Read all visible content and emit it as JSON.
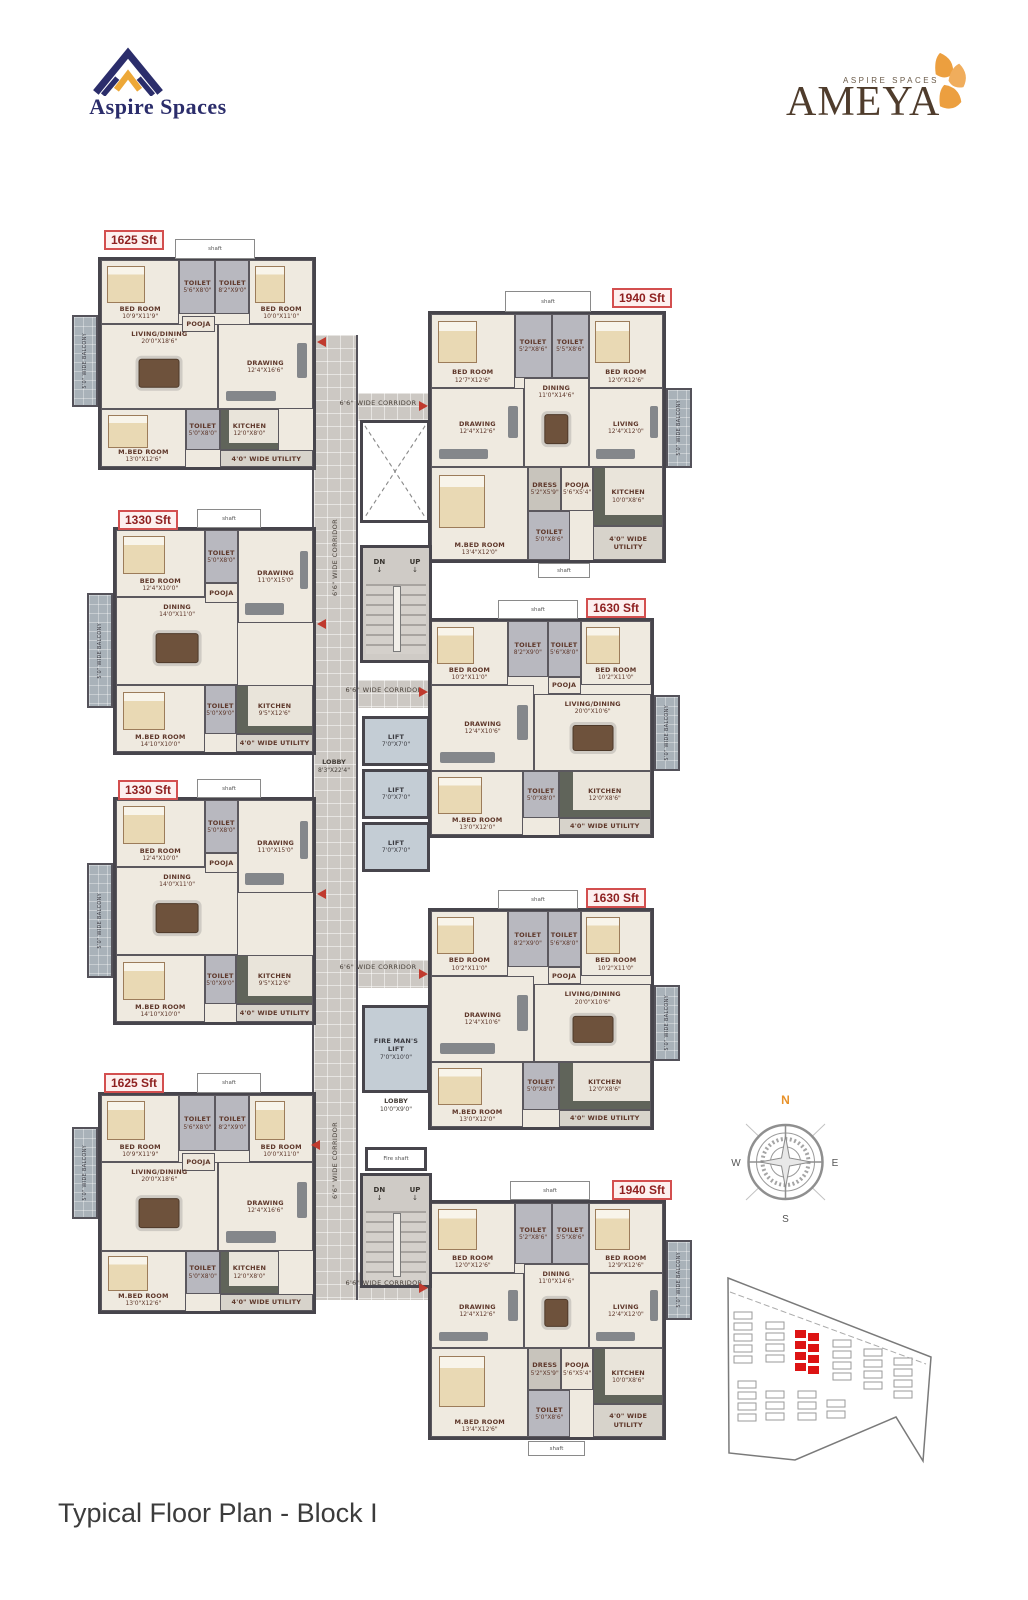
{
  "brand": {
    "left_name": "Aspire Spaces",
    "right_tag": "ASPIRE SPACES",
    "right_name": "AMEYA"
  },
  "title": "Typical Floor Plan - Block I",
  "compass": {
    "n": "N",
    "e": "E",
    "s": "S",
    "w": "W"
  },
  "core": {
    "corridor": "6'6\" WIDE CORRIDOR",
    "shaft": "shaft",
    "fire_shaft": "Fire shaft",
    "dn": "DN",
    "up": "UP",
    "lobby": "LOBBY",
    "lobby_dims": "8'3\"X22'4\"",
    "lift": "LIFT",
    "lift_dims": "7'0\"X7'0\"",
    "fire_lift": "FIRE MAN'S LIFT",
    "fire_lift_dims": "7'0\"X10'0\"",
    "lobby2": "LOBBY",
    "lobby2_dims": "10'0\"X9'0\""
  },
  "units": [
    {
      "id": "unit-1625-1",
      "sft": "1625 Sft",
      "type": "A",
      "balcony": "5'0\" WIDE BALCONY",
      "rooms": [
        {
          "label": "BED ROOM",
          "dims": "10'9\"X11'9\"",
          "kind": "bedroom"
        },
        {
          "label": "TOILET",
          "dims": "5'6\"X8'0\"",
          "kind": "toilet"
        },
        {
          "label": "TOILET",
          "dims": "8'2\"X9'0\"",
          "kind": "toilet"
        },
        {
          "label": "BED ROOM",
          "dims": "10'0\"X11'0\"",
          "kind": "bedroom"
        },
        {
          "label": "POOJA",
          "dims": "",
          "kind": "pooja"
        },
        {
          "label": "LIVING/DINING",
          "dims": "20'0\"X18'6\"",
          "kind": "dining"
        },
        {
          "label": "DRAWING",
          "dims": "12'4\"X16'6\"",
          "kind": "sofa"
        },
        {
          "label": "M.BED ROOM",
          "dims": "13'0\"X12'6\"",
          "kind": "bedroom"
        },
        {
          "label": "TOILET",
          "dims": "5'0\"X8'0\"",
          "kind": "toilet"
        },
        {
          "label": "KITCHEN",
          "dims": "12'0\"X8'0\"",
          "kind": "kitchen"
        },
        {
          "label": "4'0\" WIDE UTILITY",
          "dims": "",
          "kind": "utility"
        }
      ]
    },
    {
      "id": "unit-1940-1",
      "sft": "1940 Sft",
      "type": "B",
      "balcony": "5'0\" WIDE BALCONY",
      "rooms": [
        {
          "label": "BED ROOM",
          "dims": "12'7\"X12'6\"",
          "kind": "bedroom"
        },
        {
          "label": "TOILET",
          "dims": "5'2\"X8'6\"",
          "kind": "toilet"
        },
        {
          "label": "TOILET",
          "dims": "5'5\"X8'6\"",
          "kind": "toilet"
        },
        {
          "label": "BED ROOM",
          "dims": "12'0\"X12'6\"",
          "kind": "bedroom"
        },
        {
          "label": "DRAWING",
          "dims": "12'4\"X12'6\"",
          "kind": "sofa"
        },
        {
          "label": "DINING",
          "dims": "11'0\"X14'6\"",
          "kind": "dining"
        },
        {
          "label": "LIVING",
          "dims": "12'4\"X12'0\"",
          "kind": "sofa"
        },
        {
          "label": "M.BED ROOM",
          "dims": "13'4\"X12'0\"",
          "kind": "bedroom"
        },
        {
          "label": "DRESS",
          "dims": "5'2\"X5'9\"",
          "kind": "dress"
        },
        {
          "label": "POOJA",
          "dims": "5'6\"X5'4\"",
          "kind": "pooja"
        },
        {
          "label": "KITCHEN",
          "dims": "10'0\"X8'6\"",
          "kind": "kitchen"
        },
        {
          "label": "TOILET",
          "dims": "5'0\"X8'6\"",
          "kind": "toilet"
        },
        {
          "label": "4'0\" WIDE UTILITY",
          "dims": "",
          "kind": "utility"
        }
      ]
    },
    {
      "id": "unit-1330-1",
      "sft": "1330 Sft",
      "type": "C",
      "balcony": "5'0\" WIDE BALCONY",
      "rooms": [
        {
          "label": "BED ROOM",
          "dims": "12'4\"X10'0\"",
          "kind": "bedroom"
        },
        {
          "label": "TOILET",
          "dims": "5'0\"X8'0\"",
          "kind": "toilet"
        },
        {
          "label": "POOJA",
          "dims": "",
          "kind": "pooja"
        },
        {
          "label": "DRAWING",
          "dims": "11'0\"X15'0\"",
          "kind": "sofa"
        },
        {
          "label": "DINING",
          "dims": "14'0\"X11'0\"",
          "kind": "dining"
        },
        {
          "label": "M.BED ROOM",
          "dims": "14'10\"X10'0\"",
          "kind": "bedroom"
        },
        {
          "label": "TOILET",
          "dims": "5'0\"X9'0\"",
          "kind": "toilet"
        },
        {
          "label": "KITCHEN",
          "dims": "9'5\"X12'6\"",
          "kind": "kitchen"
        },
        {
          "label": "4'0\" WIDE UTILITY",
          "dims": "",
          "kind": "utility"
        }
      ]
    },
    {
      "id": "unit-1630-1",
      "sft": "1630 Sft",
      "type": "D",
      "balcony": "5'0\" WIDE BALCONY",
      "rooms": [
        {
          "label": "BED ROOM",
          "dims": "10'2\"X11'0\"",
          "kind": "bedroom"
        },
        {
          "label": "TOILET",
          "dims": "8'2\"X9'0\"",
          "kind": "toilet"
        },
        {
          "label": "TOILET",
          "dims": "5'6\"X8'0\"",
          "kind": "toilet"
        },
        {
          "label": "BED ROOM",
          "dims": "10'2\"X11'0\"",
          "kind": "bedroom"
        },
        {
          "label": "POOJA",
          "dims": "",
          "kind": "pooja"
        },
        {
          "label": "DRAWING",
          "dims": "12'4\"X10'6\"",
          "kind": "sofa"
        },
        {
          "label": "LIVING/DINING",
          "dims": "20'0\"X10'6\"",
          "kind": "dining"
        },
        {
          "label": "M.BED ROOM",
          "dims": "13'0\"X12'0\"",
          "kind": "bedroom"
        },
        {
          "label": "TOILET",
          "dims": "5'0\"X8'0\"",
          "kind": "toilet"
        },
        {
          "label": "KITCHEN",
          "dims": "12'0\"X8'6\"",
          "kind": "kitchen"
        },
        {
          "label": "4'0\" WIDE UTILITY",
          "dims": "",
          "kind": "utility"
        }
      ]
    },
    {
      "id": "unit-1330-2",
      "sft": "1330 Sft",
      "type": "C",
      "balcony": "5'0\" WIDE BALCONY",
      "rooms": [
        {
          "label": "BED ROOM",
          "dims": "12'4\"X10'0\"",
          "kind": "bedroom"
        },
        {
          "label": "TOILET",
          "dims": "5'0\"X8'0\"",
          "kind": "toilet"
        },
        {
          "label": "POOJA",
          "dims": "",
          "kind": "pooja"
        },
        {
          "label": "DRAWING",
          "dims": "11'0\"X15'0\"",
          "kind": "sofa"
        },
        {
          "label": "DINING",
          "dims": "14'0\"X11'0\"",
          "kind": "dining"
        },
        {
          "label": "M.BED ROOM",
          "dims": "14'10\"X10'0\"",
          "kind": "bedroom"
        },
        {
          "label": "TOILET",
          "dims": "5'0\"X9'0\"",
          "kind": "toilet"
        },
        {
          "label": "KITCHEN",
          "dims": "9'5\"X12'6\"",
          "kind": "kitchen"
        },
        {
          "label": "4'0\" WIDE UTILITY",
          "dims": "",
          "kind": "utility"
        }
      ]
    },
    {
      "id": "unit-1630-2",
      "sft": "1630 Sft",
      "type": "D",
      "balcony": "5'0\" WIDE BALCONY",
      "rooms": [
        {
          "label": "BED ROOM",
          "dims": "10'2\"X11'0\"",
          "kind": "bedroom"
        },
        {
          "label": "TOILET",
          "dims": "8'2\"X9'0\"",
          "kind": "toilet"
        },
        {
          "label": "TOILET",
          "dims": "5'6\"X8'0\"",
          "kind": "toilet"
        },
        {
          "label": "BED ROOM",
          "dims": "10'2\"X11'0\"",
          "kind": "bedroom"
        },
        {
          "label": "POOJA",
          "dims": "",
          "kind": "pooja"
        },
        {
          "label": "DRAWING",
          "dims": "12'4\"X10'6\"",
          "kind": "sofa"
        },
        {
          "label": "LIVING/DINING",
          "dims": "20'0\"X10'6\"",
          "kind": "dining"
        },
        {
          "label": "M.BED ROOM",
          "dims": "13'0\"X12'0\"",
          "kind": "bedroom"
        },
        {
          "label": "TOILET",
          "dims": "5'0\"X8'0\"",
          "kind": "toilet"
        },
        {
          "label": "KITCHEN",
          "dims": "12'0\"X8'6\"",
          "kind": "kitchen"
        },
        {
          "label": "4'0\" WIDE UTILITY",
          "dims": "",
          "kind": "utility"
        }
      ]
    },
    {
      "id": "unit-1625-2",
      "sft": "1625 Sft",
      "type": "A",
      "balcony": "5'0\" WIDE BALCONY",
      "rooms": [
        {
          "label": "BED ROOM",
          "dims": "10'9\"X11'9\"",
          "kind": "bedroom"
        },
        {
          "label": "TOILET",
          "dims": "5'6\"X8'0\"",
          "kind": "toilet"
        },
        {
          "label": "TOILET",
          "dims": "8'2\"X9'0\"",
          "kind": "toilet"
        },
        {
          "label": "BED ROOM",
          "dims": "10'0\"X11'0\"",
          "kind": "bedroom"
        },
        {
          "label": "POOJA",
          "dims": "",
          "kind": "pooja"
        },
        {
          "label": "LIVING/DINING",
          "dims": "20'0\"X18'6\"",
          "kind": "dining"
        },
        {
          "label": "DRAWING",
          "dims": "12'4\"X16'6\"",
          "kind": "sofa"
        },
        {
          "label": "M.BED ROOM",
          "dims": "13'0\"X12'6\"",
          "kind": "bedroom"
        },
        {
          "label": "TOILET",
          "dims": "5'0\"X8'0\"",
          "kind": "toilet"
        },
        {
          "label": "KITCHEN",
          "dims": "12'0\"X8'0\"",
          "kind": "kitchen"
        },
        {
          "label": "4'0\" WIDE UTILITY",
          "dims": "",
          "kind": "utility"
        }
      ]
    },
    {
      "id": "unit-1940-2",
      "sft": "1940 Sft",
      "type": "B",
      "balcony": "5'0\" WIDE BALCONY",
      "rooms": [
        {
          "label": "BED ROOM",
          "dims": "12'0\"X12'6\"",
          "kind": "bedroom"
        },
        {
          "label": "TOILET",
          "dims": "5'2\"X8'6\"",
          "kind": "toilet"
        },
        {
          "label": "TOILET",
          "dims": "5'5\"X8'6\"",
          "kind": "toilet"
        },
        {
          "label": "BED ROOM",
          "dims": "12'9\"X12'6\"",
          "kind": "bedroom"
        },
        {
          "label": "DRAWING",
          "dims": "12'4\"X12'6\"",
          "kind": "sofa"
        },
        {
          "label": "DINING",
          "dims": "11'0\"X14'6\"",
          "kind": "dining"
        },
        {
          "label": "LIVING",
          "dims": "12'4\"X12'0\"",
          "kind": "sofa"
        },
        {
          "label": "M.BED ROOM",
          "dims": "13'4\"X12'6\"",
          "kind": "bedroom"
        },
        {
          "label": "DRESS",
          "dims": "5'2\"X5'9\"",
          "kind": "dress"
        },
        {
          "label": "POOJA",
          "dims": "5'6\"X5'4\"",
          "kind": "pooja"
        },
        {
          "label": "KITCHEN",
          "dims": "10'0\"X8'6\"",
          "kind": "kitchen"
        },
        {
          "label": "TOILET",
          "dims": "5'0\"X8'6\"",
          "kind": "toilet"
        },
        {
          "label": "4'0\" WIDE UTILITY",
          "dims": "",
          "kind": "utility"
        }
      ]
    }
  ]
}
